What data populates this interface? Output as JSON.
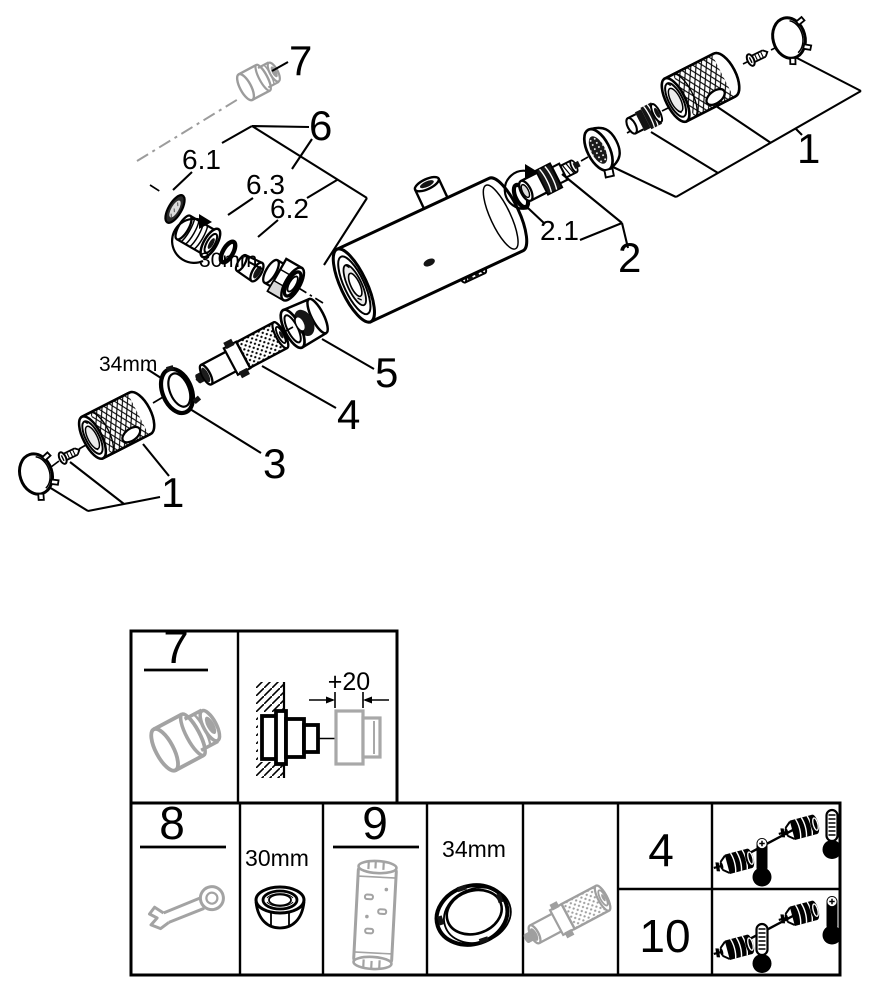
{
  "diagram": {
    "callout_labels": {
      "part7": "7",
      "group6": "6",
      "part6_1": "6.1",
      "part6_3": "6.3",
      "part6_2": "6.2",
      "nut_size": "30mm",
      "part2_1": "2.1",
      "part2": "2",
      "part1_right": "1",
      "part5": "5",
      "part4": "4",
      "part3": "3",
      "ring_size": "34mm",
      "part1_left": "1"
    }
  },
  "parts_table": {
    "cell_adapter": {
      "label": "7"
    },
    "cell_installation": {
      "dimension": "+20"
    },
    "cell_wrench": {
      "label": "8"
    },
    "cell_nut": {
      "size": "30mm"
    },
    "cell_socket_tool": {
      "label": "9"
    },
    "cell_ring": {
      "size": "34mm"
    },
    "cell_quantity_top": {
      "label": "4"
    },
    "cell_quantity_bottom": {
      "label": "10"
    }
  },
  "icons": {
    "adapter": "extension-adapter-icon",
    "installation": "wall-installation-icon",
    "wrench": "open-end-wrench-icon",
    "nut": "hex-nut-icon",
    "socket_tool": "socket-tool-icon",
    "ring": "retaining-ring-icon",
    "cartridge": "thermostatic-cartridge-icon",
    "thermometer_plus": "thermometer-plus-icon",
    "thermometer_scale": "thermometer-scale-icon"
  },
  "colors": {
    "line": "#000000",
    "secondary_part": "#9c9c9c",
    "background": "#ffffff"
  }
}
